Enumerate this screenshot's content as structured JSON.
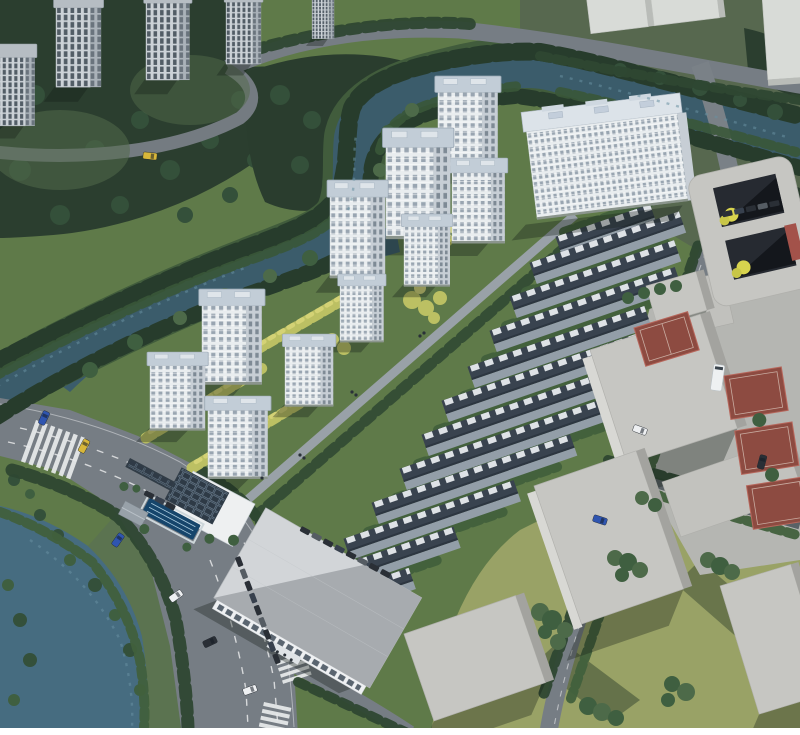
{
  "scene": {
    "title": "Residential development aerial rendering",
    "view": "bird's-eye three-quarter aerial view",
    "features": [
      "canal",
      "tree-lined boulevard",
      "high-rise towers",
      "townhouse rows",
      "clubhouse with pool",
      "solar roofs",
      "sport courts",
      "context massing blocks"
    ],
    "counts": {
      "development_towers": 11,
      "townhouse_rows": 12,
      "context_towers": 5,
      "context_slabs": 3,
      "massing_blocks": 7,
      "sport_courts": 4
    },
    "palette": {
      "base_lawn": "#5f7a49",
      "forest": "#2b3e2f",
      "ne_ground": "#57684f",
      "water": "#3b5c6b",
      "channel_water": "#466c80",
      "road": "#767d84",
      "road_minor": "#8f969c",
      "dry_grass": "#99a266",
      "plaza": "#b5b6b2",
      "tower_face": "#e9edef",
      "tower_side": "#c7ced5",
      "tower_roof": "#c2cdd7",
      "row_roof": "#39434f",
      "row_face": "#939ea8",
      "row_panel": "#e6ebee",
      "block_top": "#c6c6c2",
      "block_side": "#a3a39f",
      "court_red": "#8d4b41",
      "pool_blue": "#16456b",
      "solar_roof": "#323e49",
      "canopy": "#313c46",
      "big_roof": "#d2d5d8",
      "big_roof_shade": "#a7abaf",
      "walls": "#eef0f2",
      "tree_yellow": "#bcc063",
      "car_blue": "#2f55b0",
      "car_white": "#eef0f2",
      "car_yellow": "#d8b73a",
      "car_dark": "#2a2f36",
      "bus": "#eef1f2",
      "border": "#ffffff"
    }
  }
}
